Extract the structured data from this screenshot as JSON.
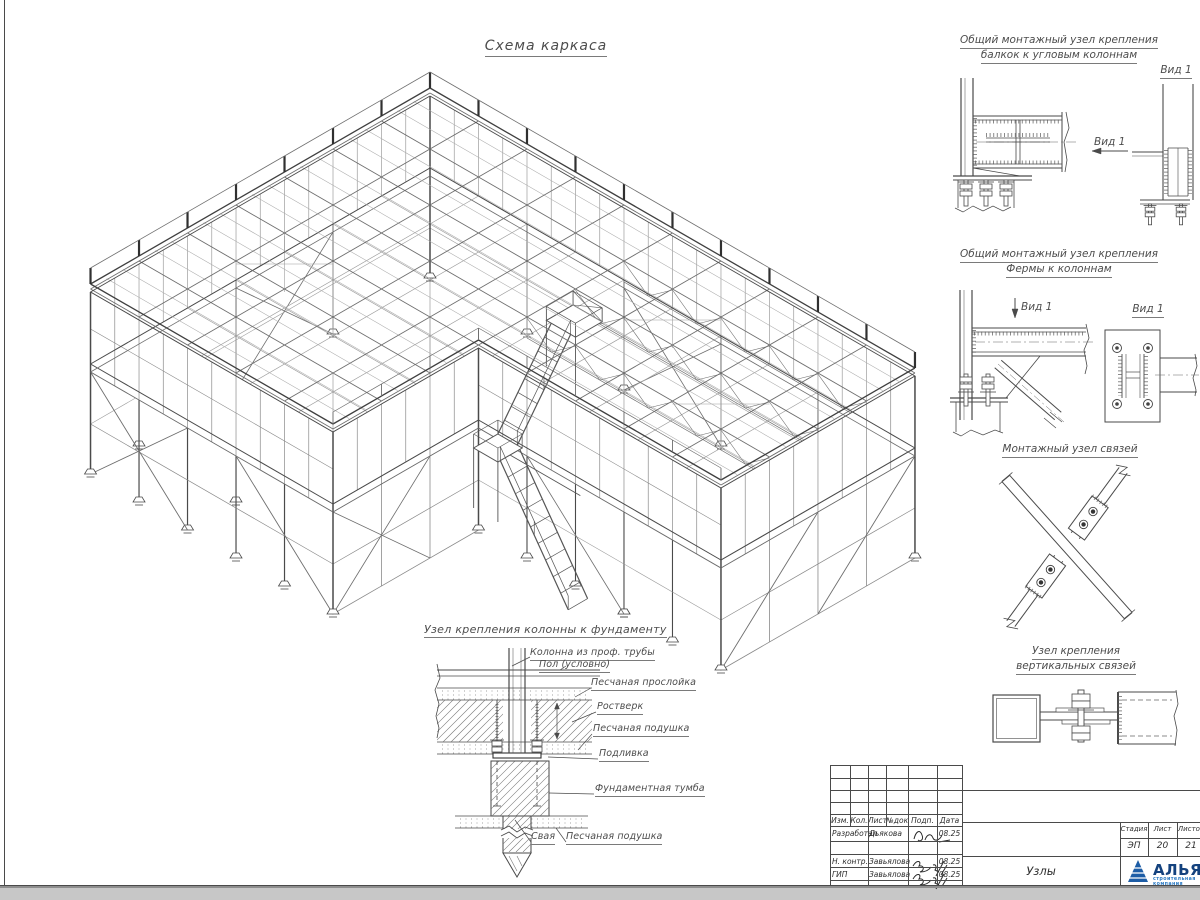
{
  "sheet": {
    "main_view": {
      "title": "Схема каркаса"
    },
    "details": {
      "d1": {
        "title_line1": "Общий монтажный узел крепления",
        "title_line2": "балкок к угловым колоннам",
        "view_label": "Вид 1",
        "view_title": "Вид 1"
      },
      "d2": {
        "title_line1": "Общий монтажный узел крепления",
        "title_line2": "Фермы к колоннам",
        "view_label": "Вид 1",
        "view_title": "Вид 1"
      },
      "d3": {
        "title": "Монтажный узел связей"
      },
      "d4": {
        "title_line1": "Узел крепления",
        "title_line2": "вертикальных связей"
      },
      "d5": {
        "title": "Узел крепления колонны к фундаменту",
        "labels": {
          "column": "Колонна из проф. трубы",
          "floor": "Пол (условно)",
          "sand_layer": "Песчаная прослойка",
          "grillage": "Ростверк",
          "sand_cushion": "Песчаная подушка",
          "grout": "Подливка",
          "pedestal": "Фундаментная тумба",
          "pile": "Свая",
          "sand_cushion2": "Песчаная подушка"
        }
      }
    },
    "title_block": {
      "rev_headers": [
        "Изм.",
        "Кол.",
        "Лист",
        "№док",
        "Подп.",
        "Дата"
      ],
      "sign_rows": [
        {
          "role": "Разработал",
          "name": "Дьякова",
          "date": "08.25"
        },
        {
          "role": "Н. контр.",
          "name": "Завьялова",
          "date": "08.25"
        },
        {
          "role": "ГИП",
          "name": "Завьялова",
          "date": "08.25"
        }
      ],
      "stage_headers": [
        "Стадия",
        "Лист",
        "Листов"
      ],
      "stage_values": [
        "ЭП",
        "20",
        "21"
      ],
      "doc_title": "Узлы",
      "company": {
        "name": "АЛЬЯНС",
        "subtitle": "строительная компания",
        "accent_color": "#1d5da6"
      }
    }
  }
}
